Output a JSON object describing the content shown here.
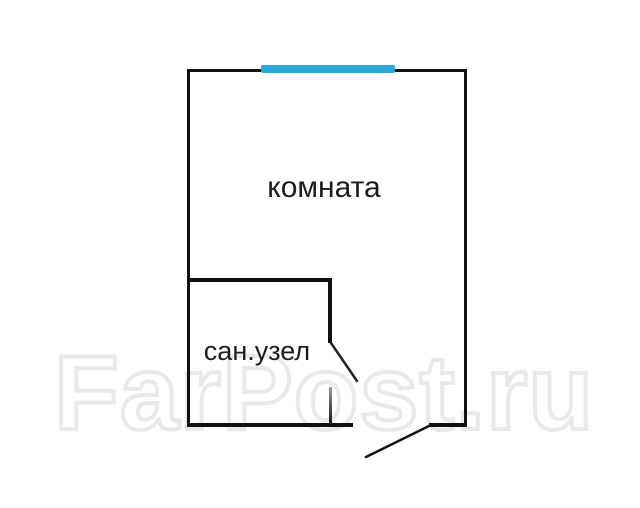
{
  "plan": {
    "room_label": "комната",
    "bathroom_label": "сан.узел",
    "watermark_text": "FarPost.ru",
    "colors": {
      "wall": "#111111",
      "window": "#2fa9dd",
      "watermark_stroke": "#e9e9e9",
      "label_text": "#1c1c1c",
      "background": "#ffffff"
    }
  }
}
